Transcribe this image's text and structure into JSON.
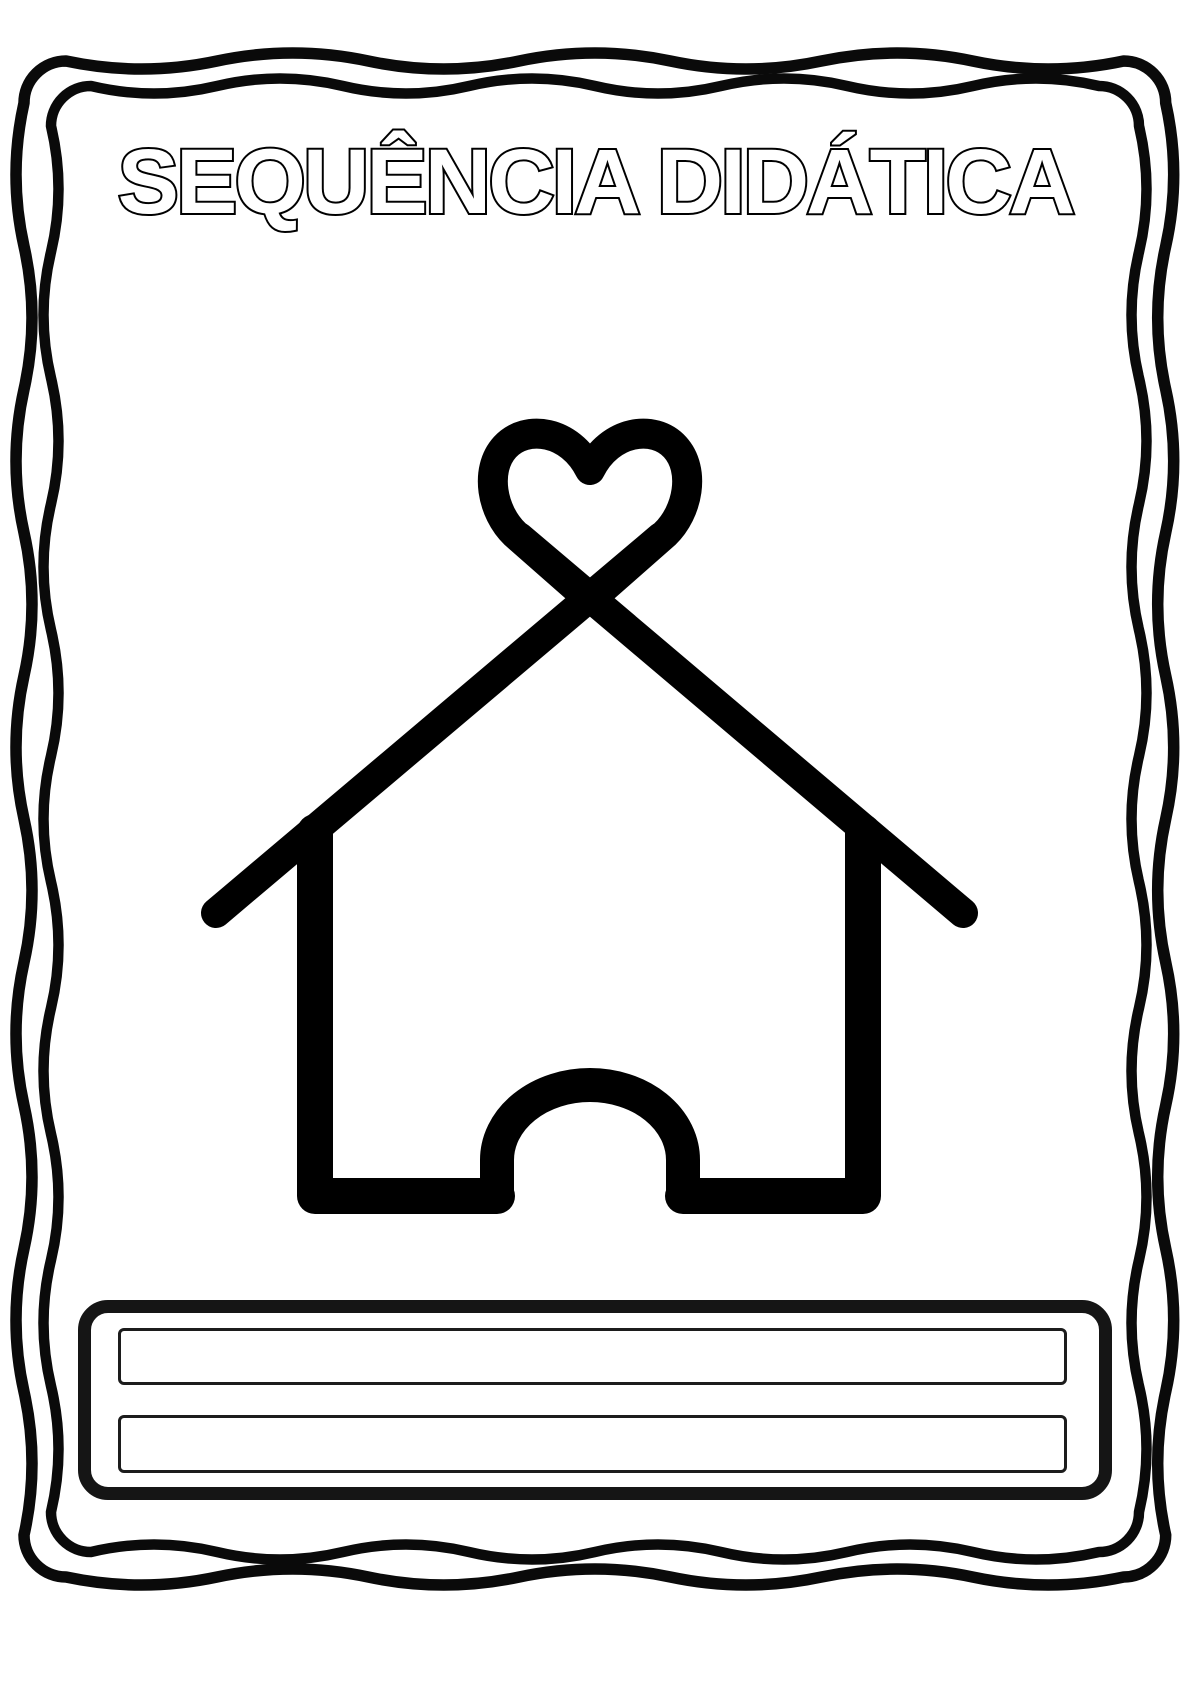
{
  "page": {
    "background": "#ffffff",
    "ink": "#000000"
  },
  "title": {
    "text": "SEQUÊNCIA DIDÁTICA",
    "fill": "#ffffff",
    "outline": "#000000"
  },
  "icon": {
    "name": "house-with-heart-icon",
    "description": "Outlined house whose crossed roof beams form a heart at the apex, with an arched open doorway"
  },
  "footer": {
    "fields": [
      {
        "value": ""
      },
      {
        "value": ""
      }
    ]
  }
}
